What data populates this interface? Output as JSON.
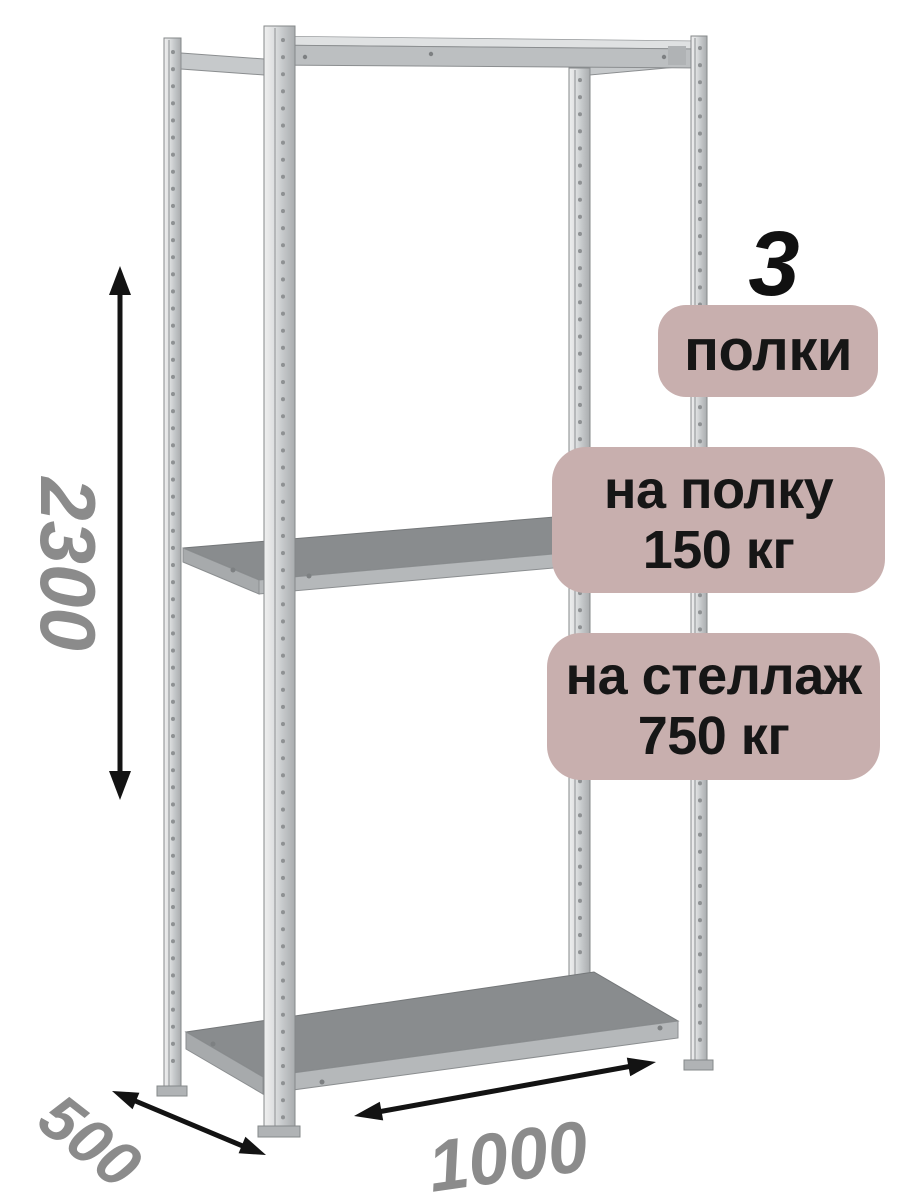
{
  "annotations": {
    "shelf_count": {
      "value": "3",
      "label": "полки"
    },
    "load_per_shelf": {
      "line1": "на полку",
      "line2": "150 кг"
    },
    "load_per_rack": {
      "line1": "на стеллаж",
      "line2": "750 кг"
    }
  },
  "dimensions": {
    "height": "2300",
    "depth": "500",
    "width": "1000"
  },
  "icons": {
    "height_arrow": "double-headed-arrow-vertical",
    "depth_arrow": "double-headed-arrow-diagonal",
    "width_arrow": "double-headed-arrow-diagonal"
  },
  "colors": {
    "background": "#ffffff",
    "badge_bg": "#c8afae",
    "badge_text": "#161616",
    "count_text": "#111111",
    "dimension_text": "#8b8b8b",
    "arrow": "#131313"
  }
}
